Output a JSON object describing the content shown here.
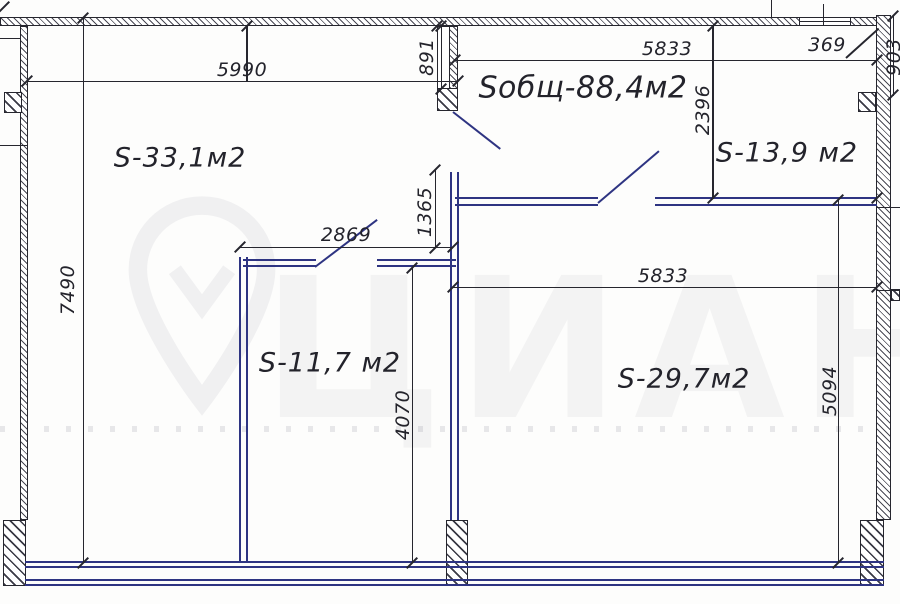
{
  "drawing": {
    "type": "apartment floor plan",
    "labels": {
      "total": "Sобщ-88,4м2",
      "room_331": "S-33,1м2",
      "room_139": "S-13,9 м2",
      "room_117": "S-11,7 м2",
      "room_297": "S-29,7м2"
    },
    "dims": {
      "w_room_331": "5990",
      "entry_niche_depth": "891",
      "w_top_right": "5833",
      "niche_right": "369",
      "h_right_top": "903",
      "h_room_139": "2396",
      "hall_opening": "1365",
      "w_room_117": "2869",
      "h_left_total": "7490",
      "w_room_297": "5833",
      "h_room_117": "4070",
      "h_room_297": "5094"
    }
  },
  "watermark": {
    "brand_text": "ЦИАН"
  },
  "colors": {
    "wall_line": "#26262e",
    "partition_blue": "#2e3482",
    "background": "#fdfdfc",
    "watermark_gray": "rgba(70,70,95,0.06)"
  }
}
